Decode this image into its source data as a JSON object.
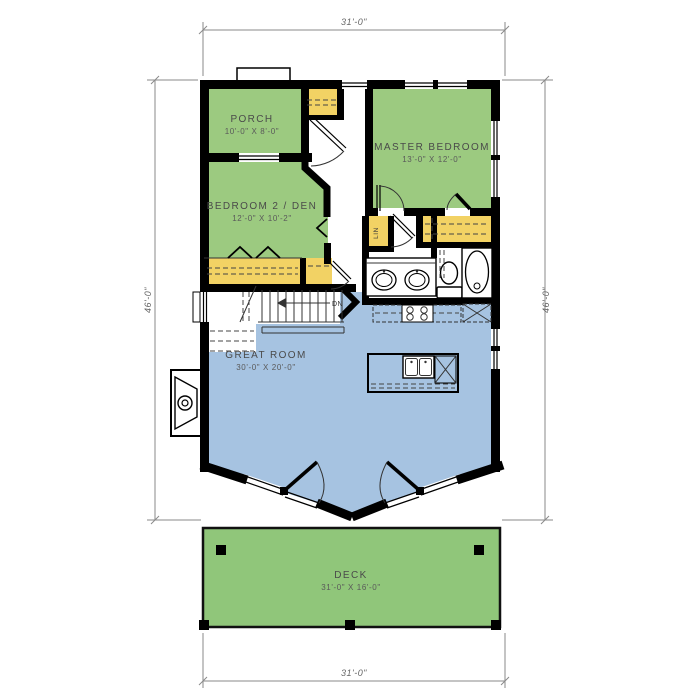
{
  "plan": {
    "rooms": [
      {
        "id": "porch",
        "name": "PORCH",
        "size": "10'-0\" X 8'-0\""
      },
      {
        "id": "master",
        "name": "MASTER BEDROOM",
        "size": "13'-0\" X 12'-0\""
      },
      {
        "id": "bedroom2",
        "name": "BEDROOM 2 / DEN",
        "size": "12'-0\" X 10'-2\""
      },
      {
        "id": "great",
        "name": "GREAT ROOM",
        "size": "30'-0\" X 20'-0\""
      },
      {
        "id": "deck",
        "name": "DECK",
        "size": "31'-0\" X 16'-0\""
      }
    ],
    "dimensions": {
      "top": "31'-0\"",
      "bottom": "31'-0\"",
      "left": "46'-0\"",
      "right": "46'-0\""
    },
    "annotations": {
      "linen": "LIN",
      "stair_direction": "DN"
    },
    "colors": {
      "room_green": "#9cca80",
      "deck_green": "#90c67a",
      "great_room_blue": "#a6c3e1",
      "closet_yellow": "#f2d264",
      "wall_black": "#000000",
      "dimension_gray": "#8a8a8a",
      "label_gray": "#4a4a4a"
    }
  }
}
